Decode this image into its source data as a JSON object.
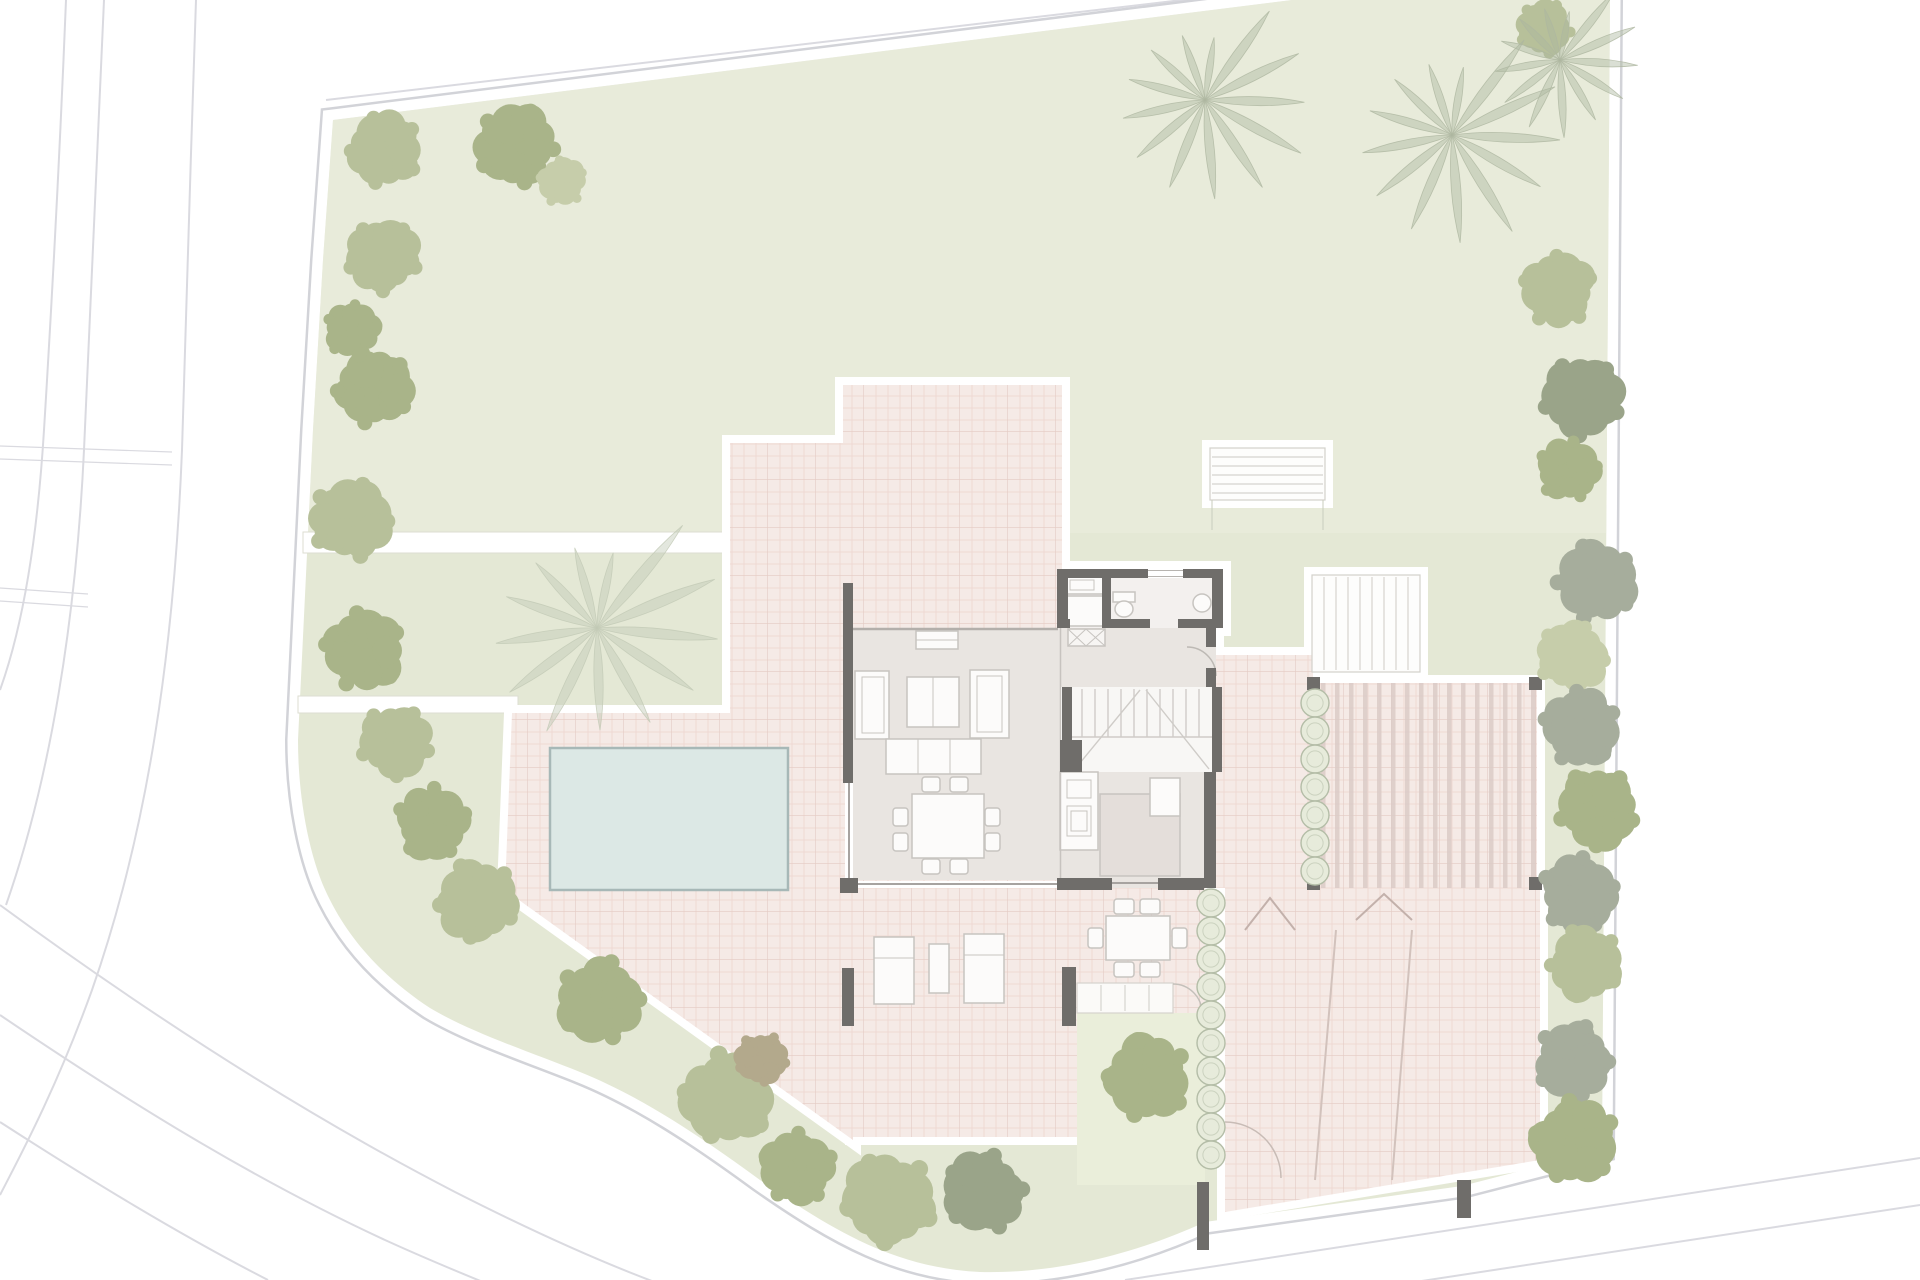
{
  "title": "Ground floor site plan of a villa with garden, swimming pool, terraces, pergola and driveway",
  "plan": {
    "drawing_type": "architectural site plan",
    "areas": [
      "garden",
      "upper-terrace",
      "pool-terrace",
      "swimming-pool",
      "living-room",
      "dining-area",
      "kitchen",
      "bathroom",
      "hallway",
      "interior-staircase",
      "lower-terrace",
      "pergola",
      "driveway",
      "garden-steps",
      "exterior-stair",
      "roads"
    ]
  },
  "palette": {
    "page": "#ffffff",
    "garden": "#e4e8d5",
    "garden_light": "#eceee0",
    "garden_patch": "#eaeeda",
    "terrace_base": "#f5eae6",
    "terrace_grid": "#ecd6d0",
    "terrace_grid2": "#e4cbc4",
    "stripe": "#dbccc7",
    "floor": "#e9e5e1",
    "floor_bath": "#f3f0ee",
    "floor_stair": "#f8f7f5",
    "wall": "#6f6d6a",
    "pool_fill": "#dce8e5",
    "pool_border": "#a7b8b7",
    "furniture_fill": "#fcfbfa",
    "furniture_stroke": "#c7c4c0",
    "tread": "#cfccc8",
    "thin_line": "#b3afab",
    "arc": "#bdb9b4",
    "road_line": "#dadae0",
    "boundary_line": "#d2d3d8",
    "drive_mark": "#c3b1ab",
    "tree_olive": "#b7c09a",
    "tree_olive2": "#a9b489",
    "tree_sage": "#c6cdaa",
    "tree_gray": "#a6ad9c",
    "tree_graygreen": "#9aa489",
    "tree_brown": "#b3a98c",
    "palm": "#aeb7a0",
    "palm_pool": "#c2c9b5",
    "hedge_fill": "#e7ebdb",
    "hedge_stroke": "#b4bda7"
  },
  "pool": {
    "x": 550,
    "y": 748,
    "width": 238,
    "height": 142
  },
  "vegetation": {
    "trees": [
      [
        385,
        150,
        40,
        "tree_olive"
      ],
      [
        516,
        146,
        44,
        "tree_olive2"
      ],
      [
        562,
        182,
        26,
        "tree_sage"
      ],
      [
        383,
        257,
        40,
        "tree_olive"
      ],
      [
        352,
        330,
        30,
        "tree_olive2"
      ],
      [
        373,
        388,
        42,
        "tree_olive2"
      ],
      [
        350,
        520,
        44,
        "tree_olive"
      ],
      [
        363,
        650,
        44,
        "tree_olive2"
      ],
      [
        395,
        742,
        40,
        "tree_olive"
      ],
      [
        432,
        822,
        40,
        "tree_olive2"
      ],
      [
        477,
        900,
        44,
        "tree_olive"
      ],
      [
        600,
        1000,
        46,
        "tree_olive2"
      ],
      [
        728,
        1096,
        50,
        "tree_olive"
      ],
      [
        762,
        1058,
        28,
        "tree_brown"
      ],
      [
        798,
        1167,
        40,
        "tree_olive2"
      ],
      [
        890,
        1200,
        50,
        "tree_olive"
      ],
      [
        985,
        1192,
        44,
        "tree_graygreen"
      ],
      [
        1148,
        1078,
        46,
        "tree_olive2"
      ],
      [
        1545,
        28,
        30,
        "tree_olive"
      ],
      [
        1558,
        290,
        40,
        "tree_olive"
      ],
      [
        1582,
        398,
        44,
        "tree_graygreen"
      ],
      [
        1568,
        470,
        34,
        "tree_olive2"
      ],
      [
        1595,
        582,
        44,
        "tree_gray"
      ],
      [
        1572,
        657,
        38,
        "tree_sage"
      ],
      [
        1580,
        727,
        42,
        "tree_gray"
      ],
      [
        1597,
        808,
        44,
        "tree_olive2"
      ],
      [
        1578,
        893,
        42,
        "tree_gray"
      ],
      [
        1585,
        963,
        40,
        "tree_olive"
      ],
      [
        1573,
        1060,
        42,
        "tree_gray"
      ],
      [
        1575,
        1140,
        46,
        "tree_olive2"
      ]
    ],
    "palms": [
      [
        1205,
        100,
        115,
        "palm",
        1
      ],
      [
        1452,
        135,
        125,
        "palm",
        2
      ],
      [
        1560,
        60,
        90,
        "palm",
        3
      ],
      [
        597,
        628,
        140,
        "palm_pool",
        4
      ]
    ],
    "hedge_rows": [
      {
        "x": 1315,
        "y_start": 703,
        "count": 7,
        "spacing": 28,
        "radius": 14
      },
      {
        "x": 1211,
        "y_start": 903,
        "count": 10,
        "spacing": 28,
        "radius": 14
      }
    ]
  }
}
